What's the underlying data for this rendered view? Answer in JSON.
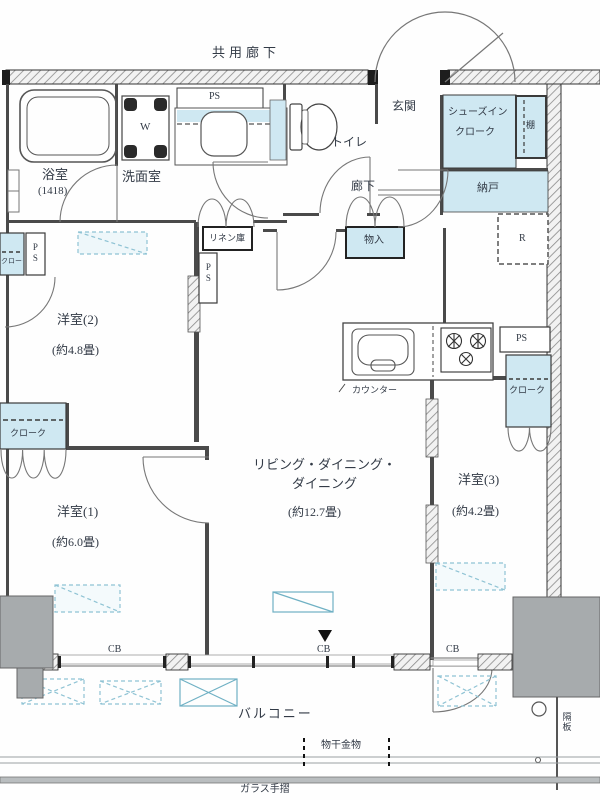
{
  "colors": {
    "fill_blue": "#cfe8f2",
    "wall_dark": "#3f3f46",
    "hatch_line": "#8a8a8a",
    "gray_block": "#a7abad",
    "text": "#323a46",
    "dash_blue": "#8fc3d4"
  },
  "top": {
    "common_corridor": "共用廊下"
  },
  "rooms": {
    "bathroom": {
      "name": "浴室",
      "size": "(1418)"
    },
    "washroom": {
      "name": "洗面室",
      "washer": "W",
      "ps": "PS"
    },
    "toilet": {
      "name": "トイレ"
    },
    "entrance": {
      "name": "玄関"
    },
    "shoes_closet": {
      "line1": "シューズイン",
      "line2": "クローク",
      "shelf": "棚"
    },
    "storeroom": {
      "name": "納戸",
      "fridge": "R"
    },
    "hallway": {
      "name": "廊下",
      "storage": "物入",
      "linen": "リネン庫"
    },
    "room2": {
      "name": "洋室(2)",
      "size": "(約4.8畳)",
      "ps": "PS",
      "cloak": "クローク"
    },
    "room1": {
      "name": "洋室(1)",
      "size": "(約6.0畳)",
      "cloak": "クローク"
    },
    "ldk": {
      "line1": "リビング・ダイニング・",
      "line2": "ダイニング",
      "size": "(約12.7畳)",
      "counter": "カウンター"
    },
    "room3": {
      "name": "洋室(3)",
      "size": "(約4.2畳)",
      "ps": "PS",
      "cloak": "クローク"
    }
  },
  "balcony": {
    "name": "バルコニー",
    "laundry": "物干金物",
    "glass_rail": "ガラス手摺",
    "partition": "隔板",
    "cb": "CB"
  }
}
